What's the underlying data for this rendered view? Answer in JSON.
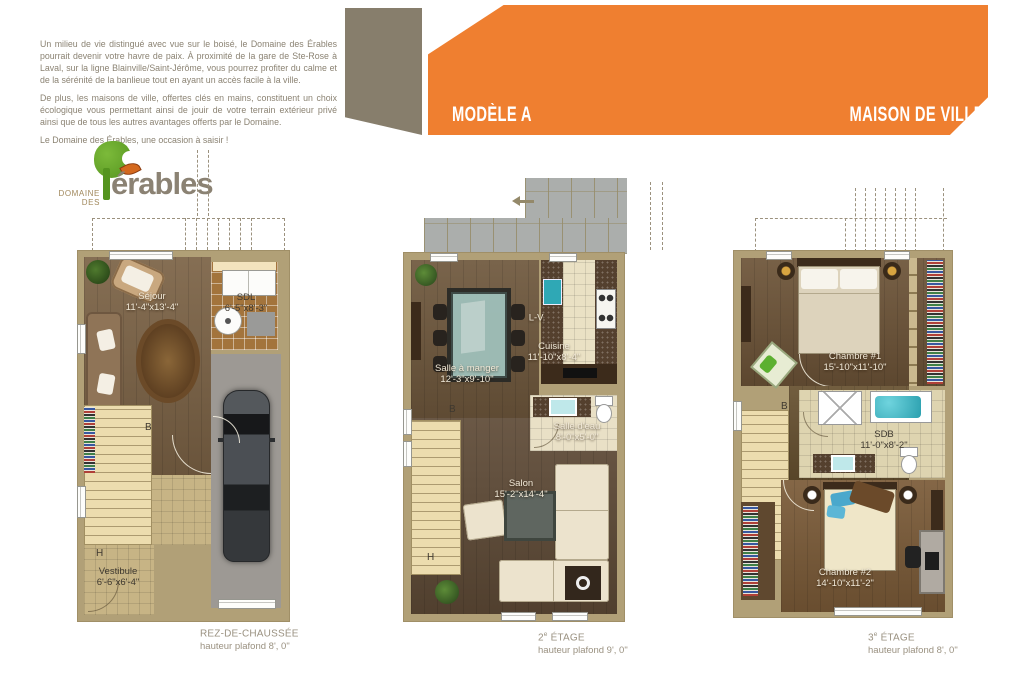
{
  "intro": {
    "p1": "Un milieu de vie distingué avec vue sur le boisé, le Domaine des Érables pourrait devenir votre havre de paix.  À proximité de la gare de Ste-Rose à Laval, sur la ligne Blainville/Saint-Jérôme, vous pourrez profiter du calme et de la sérénité de la banlieue tout en ayant un accès facile à la ville.",
    "p2": "De plus, les maisons de ville, offertes clés en mains, constituent un choix écologique vous permettant ainsi de jouir de votre terrain extérieur privé ainsi que de tous les autres avantages offerts par le Domaine.",
    "p3": "Le Domaine des Érables, une occasion à saisir !"
  },
  "logo": {
    "domaine": "DOMAINE",
    "des": "DES",
    "name": "érables"
  },
  "banner": {
    "model": "MODÈLE A",
    "type": "MAISON DE VILLE"
  },
  "colors": {
    "orange": "#EF7F30",
    "taupe": "#877E6C",
    "wall": "#B1A077",
    "body_text": "#8B8373"
  },
  "plans": {
    "rdc": {
      "caption": {
        "num": "",
        "sup": "",
        "title": "REZ-DE-CHAUSSÉE",
        "sub": "hauteur plafond 8', 0\""
      },
      "sejour": {
        "name": "Séjour",
        "dims": "11'-4\"x13'-4\""
      },
      "sdl": {
        "name": "SDL",
        "dims": "6'-5\"x8'-3\""
      },
      "vestibule": {
        "name": "Vestibule",
        "dims": "6'-6\"x6'-4\""
      },
      "door_b": "B",
      "door_h": "H"
    },
    "etage2": {
      "caption": {
        "num": "2",
        "sup": "e",
        "title": " ÉTAGE",
        "sub": "hauteur plafond 9', 0\""
      },
      "salle_a_manger": {
        "name": "Salle à manger",
        "dims": "12'-3\"x9'-10\""
      },
      "cuisine": {
        "name": "Cuisine",
        "dims": "11'-10\"x8'-4\""
      },
      "lave_vaisselle": "L-V.",
      "salle_eau": {
        "name": "Salle d'eau",
        "dims": "8'-0\"x5'-0\""
      },
      "salon": {
        "name": "Salon",
        "dims": "15'-2\"x14'-4\""
      },
      "door_b": "B",
      "door_h": "H"
    },
    "etage3": {
      "caption": {
        "num": "3",
        "sup": "e",
        "title": " ÉTAGE",
        "sub": "hauteur plafond 8', 0\""
      },
      "chambre1": {
        "name": "Chambre #1",
        "dims": "15'-10\"x11'-10\""
      },
      "sdb": {
        "name": "SDB",
        "dims": "11'-0\"x8'-2\""
      },
      "chambre2": {
        "name": "Chambre #2",
        "dims": "14'-10\"x11'-2\""
      },
      "door_b": "B"
    }
  }
}
